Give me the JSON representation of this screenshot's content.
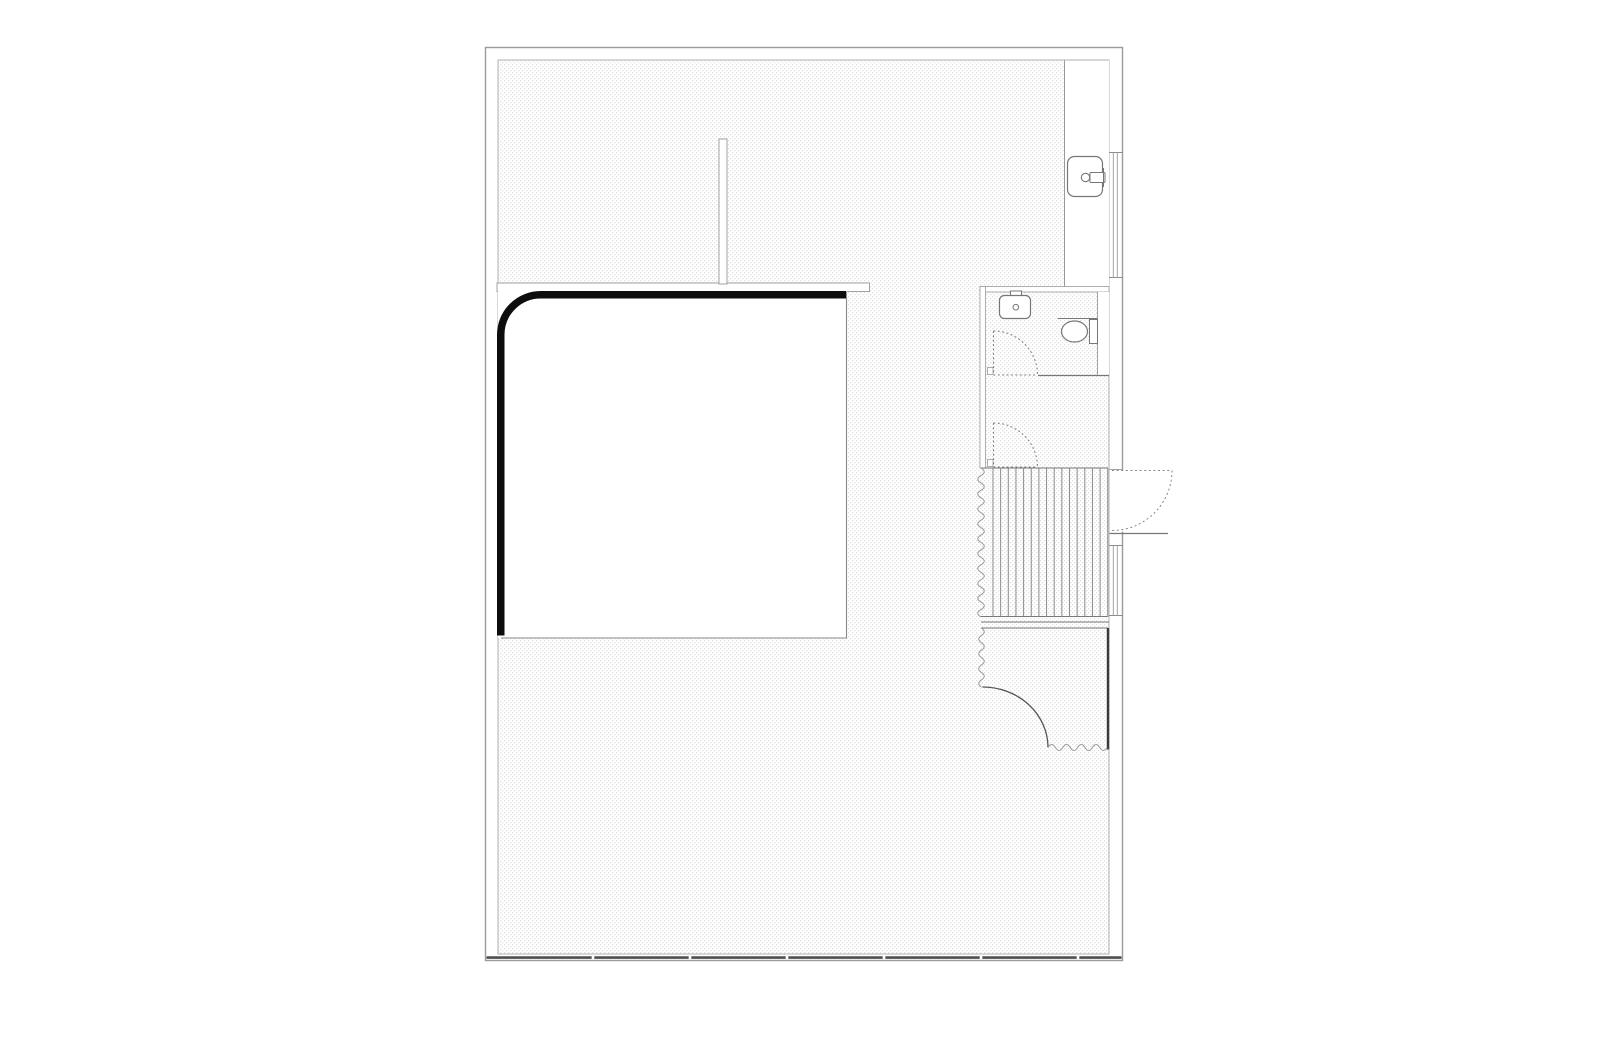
{
  "canvas": {
    "width": 1600,
    "height": 1061,
    "background": "#ffffff"
  },
  "palette": {
    "outer_wall_line": "#9a9a9a",
    "thin_line": "#8c8c8c",
    "wall_line": "#999999",
    "dark_line": "#4f4f4f",
    "accent_black": "#0d0d0d",
    "bold_gray": "#3a3a3a",
    "hatch_dot": "#e0e0e0",
    "door_dash": "#777777",
    "white": "#ffffff"
  },
  "elements": {
    "stairs": {
      "tread_count": 16,
      "x_start": 993,
      "step": 7.65,
      "y_top": 468.5,
      "y_bottom": 616.5,
      "color": "#8c8c8c"
    },
    "facade": {
      "y": 957.6,
      "x1": 486.5,
      "x2": 1121.5,
      "thickness": 2.6,
      "color": "#4f4f4f",
      "mullion_xs": [
        593,
        690,
        787,
        884,
        981,
        1078
      ]
    },
    "windows": [
      {
        "x1": 1109,
        "x2": 1123,
        "y1": 152.5,
        "y2": 277.5
      },
      {
        "x1": 1109,
        "x2": 1123,
        "y1": 545.5,
        "y2": 615.5
      }
    ],
    "interior_doors": [
      {
        "name": "bathroom-door",
        "cx": 993.5,
        "cy": 375,
        "r": 44
      },
      {
        "name": "closet-door",
        "cx": 993.5,
        "cy": 467,
        "r": 44
      }
    ],
    "entry_door": {
      "cx": 1112,
      "cy": 470.5,
      "r": 60
    },
    "fixtures": [
      "wall-sink",
      "bathroom-sink",
      "toilet"
    ]
  }
}
